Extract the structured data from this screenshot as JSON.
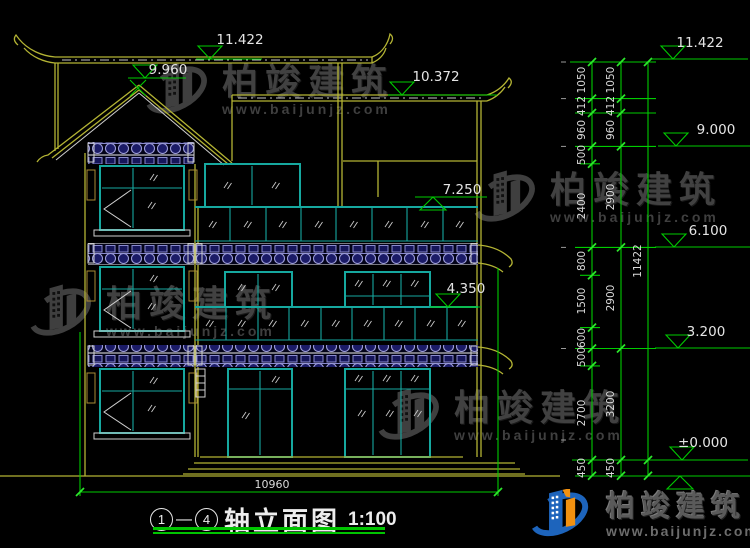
{
  "watermark": {
    "brand": "柏竣建筑",
    "url": "www.baijunjz.com"
  },
  "logo": {
    "brand": "柏竣建筑",
    "url": "www.baijunjz.com"
  },
  "title": {
    "axis_start": "1",
    "separator": "—",
    "axis_end": "4",
    "name": "轴立面图",
    "scale": "1:100"
  },
  "labels": {
    "ridge": "11.422",
    "roof2": "10.372",
    "gable": "9.960",
    "balcony3": "7.250",
    "balcony2": "4.350",
    "width": "10960"
  },
  "elevations": {
    "e11": "11.422",
    "e9": "9.000",
    "e6": "6.100",
    "e3": "3.200",
    "e0": "±0.000"
  },
  "dims": {
    "inner": [
      "1050",
      "412",
      "960",
      "500",
      "2400",
      "800",
      "1500",
      "600",
      "500",
      "2700",
      "450"
    ],
    "outer": [
      "1050",
      "412",
      "960",
      "2900",
      "2900",
      "3200",
      "450"
    ],
    "total": "11422"
  }
}
